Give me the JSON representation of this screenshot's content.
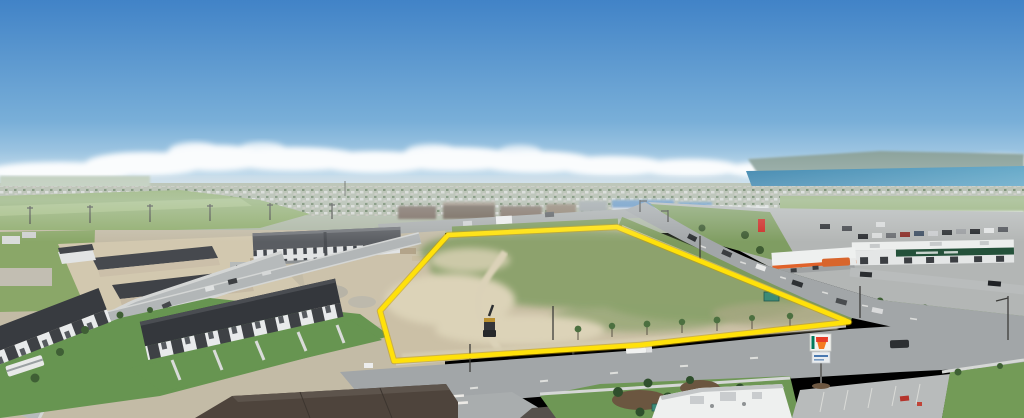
{
  "meta": {
    "type": "aerial-photograph",
    "subject": "Drone photo of a vacant development land parcel outlined in yellow, surrounded by suburban townhomes, an apartment building, arterial roads, retail strip with gas station and 7-Eleven, with a lake and hills on the horizon",
    "width_px": 1024,
    "height_px": 418,
    "visible_text": []
  },
  "scene": {
    "palette": {
      "sky_top": "#4183c7",
      "sky_mid": "#79afd8",
      "sky_horizon": "#cfe3ee",
      "cloud": "#ffffff",
      "hills": "#8ba29b",
      "lake": "#2f7da8",
      "lake_light": "#55a0c3",
      "field": "#85a263",
      "grass_verge": "#7d9a5e",
      "lawn": "#679551",
      "parcel_dirt": "#cbc0a6",
      "parcel_grass": "#7e9b60",
      "scrub": "#a8a883",
      "asphalt": "#a2a6a8",
      "concrete": "#c9cccb",
      "roof_dark": "#34373c",
      "roof_brown": "#4e443c",
      "wall_light": "#e6e8e9",
      "green_fascia": "#24513a",
      "canopy_orange": "#e0622a",
      "boundary_yellow": "#ffe10a"
    },
    "boundary": {
      "label": "property-boundary-outline",
      "color": "#ffe10a",
      "shape": "five-sided polygon around graded vacant lot"
    },
    "landmarks": [
      {
        "name": "vacant-parcel",
        "desc": "graded tan dirt lot with green grass patches and machine tracks"
      },
      {
        "name": "excavator",
        "desc": "construction excavator parked on dirt near south edge of parcel"
      },
      {
        "name": "apartment-building",
        "desc": "long four-storey condo block west of parcel"
      },
      {
        "name": "townhouse-rows",
        "desc": "dark-roofed townhomes in foreground and under construction to the northwest"
      },
      {
        "name": "strip-mall",
        "desc": "white retail building with dark-green fascia east of parcel"
      },
      {
        "name": "gas-station",
        "desc": "fuel canopy with orange stripe and tanker truck"
      },
      {
        "name": "seven-eleven-sign",
        "desc": "7-Eleven pylon sign near foreground intersection"
      },
      {
        "name": "lake",
        "desc": "blue lake with hills on the northeast horizon"
      }
    ]
  }
}
